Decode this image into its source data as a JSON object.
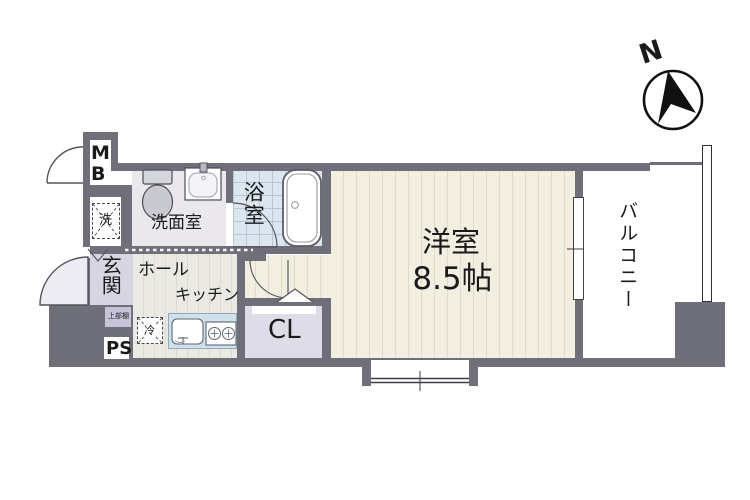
{
  "compass": {
    "north_label": "N"
  },
  "rooms": {
    "western_room": {
      "name": "洋室",
      "size": "8.5帖"
    },
    "balcony": {
      "name": "バルコニー"
    },
    "bathroom": {
      "name": "浴室"
    },
    "washroom": {
      "name": "洗面室"
    },
    "entrance": {
      "name": "玄関"
    },
    "hall": {
      "name": "ホール"
    },
    "kitchen": {
      "name": "キッチン"
    },
    "closet": {
      "name": "CL"
    }
  },
  "fixtures": {
    "meter_box": "MB",
    "pipe_space": "PS",
    "washing_machine": "洗",
    "refrigerator": "冷",
    "upper_shelf": "上部棚"
  },
  "colors": {
    "wall": "#6f6f79",
    "main_floor": "#f2efe1",
    "main_floor_stripe": "#dfdccb",
    "hall_floor": "#ebe9e3",
    "bathroom_tile": "#dce6f0",
    "kitchen_counter": "#cfe1eb",
    "entrance_floor": "#d8d5e2",
    "closet_floor": "#dedce6",
    "washroom_floor": "#eae8ec",
    "door_swing": "#ececf2",
    "compass_ink": "#111111"
  }
}
